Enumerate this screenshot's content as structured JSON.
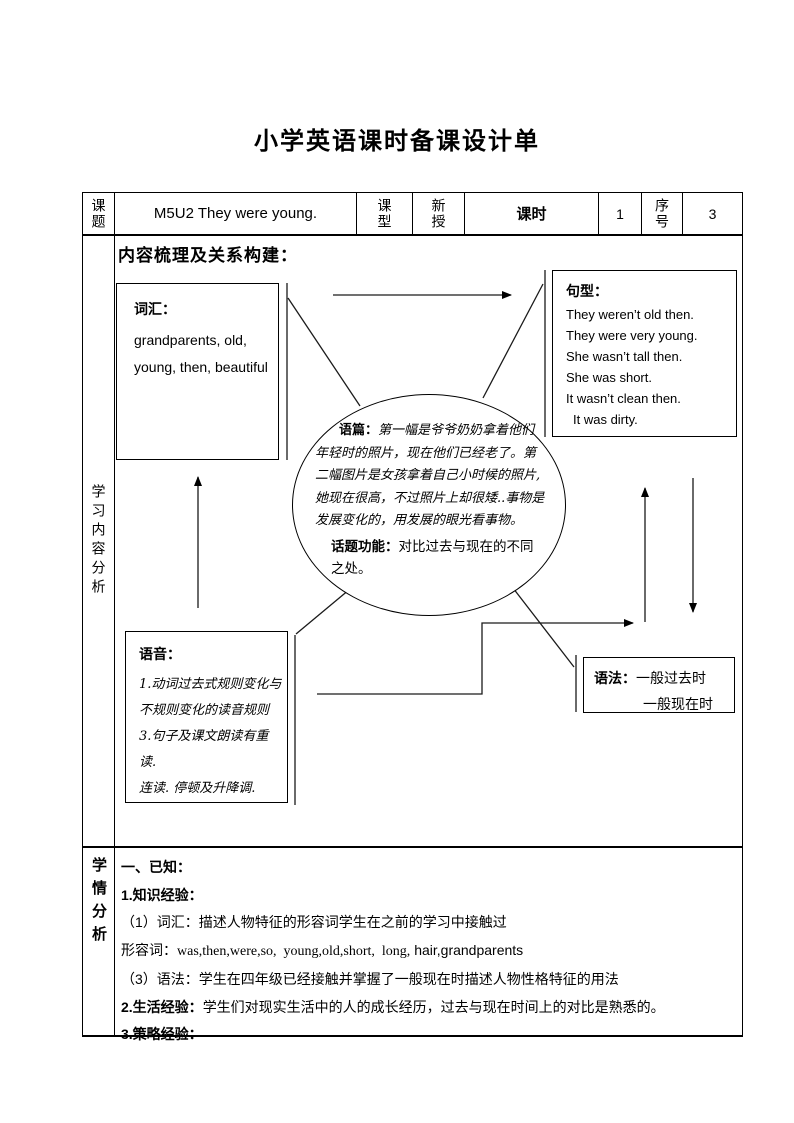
{
  "page": {
    "title": "小学英语课时备课设计单"
  },
  "header": {
    "subject_label": "课题",
    "subject_value": "M5U2 They were young.",
    "type_label": "课型",
    "type_value": "新授",
    "period_label": "课时",
    "period_value": "1",
    "serial_label": "序号",
    "serial_value": "3"
  },
  "content_analysis": {
    "row_label": "学习内容分析",
    "heading": "内容梳理及关系构建：",
    "vocab": {
      "label": "词汇：",
      "lines": [
        "grandparents, old,",
        "young, then, beautiful"
      ]
    },
    "sentences": {
      "label": "句型：",
      "lines": [
        "They weren’t old then.",
        "They were very young.",
        "She wasn’t tall then.",
        "She was short.",
        "It wasn’t clean then.",
        "It was dirty."
      ]
    },
    "passage": {
      "label": "语篇：",
      "text": "第一幅是爷爷奶奶拿着他们年轻时的照片，现在他们已经老了。第二幅图片是女孩拿着自己小时候的照片,她现在很高，不过照片上却很矮..事物是发展变化的，用发展的眼光看事物。",
      "topic_label": "话题功能：",
      "topic_text": "对比过去与现在的不同之处。"
    },
    "phonics": {
      "label": "语音：",
      "lines": [
        "1.动词过去式规则变化与",
        "不规则变化的读音规则",
        "3.句子及课文朗读有重读.",
        "连读. 停顿及升降调."
      ]
    },
    "grammar": {
      "label": "语法：",
      "line1": "一般过去时",
      "line2": "一般现在时"
    }
  },
  "learner_analysis": {
    "row_label": "学情分析",
    "line1": "一、已知：",
    "line2": "1.知识经验：",
    "line3": "（1）词汇：描述人物特征的形容词学生在之前的学习中接触过",
    "line4_label": "形容词：",
    "line4_serif": "was,then,were,so,  young,old,short,  long,",
    "line4_sans": " hair,grandparents",
    "line5": "（3）语法：学生在四年级已经接触并掌握了一般现在时描述人物性格特征的用法",
    "line6_label": "2.生活经验：",
    "line6_text": "学生们对现实生活中的人的成长经历，过去与现在时间上的对比是熟悉的。",
    "line7": "3.策略经验："
  }
}
